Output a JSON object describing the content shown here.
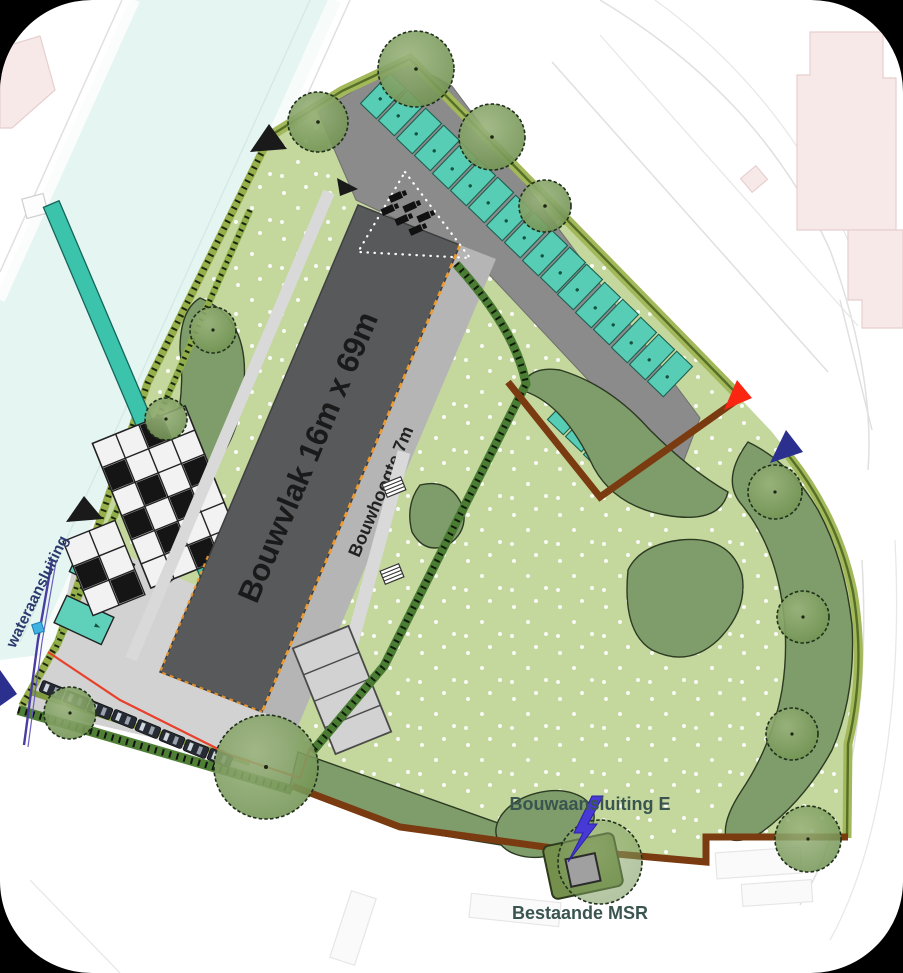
{
  "plan": {
    "title_labels": {
      "building_envelope": "Bouwvlak 16m x 69m",
      "building_height": "Bouwhoogte 7m",
      "water_connection": "wateraansluiting",
      "power_connection": "Bouwaansluiting E",
      "existing_msr": "Bestaande MSR"
    },
    "colors": {
      "lawn_green": "#c4d79d",
      "shrub_green": "#7e9d6a",
      "tree_green": "#78995c",
      "hedge_olive": "#a3b85a",
      "hedge_dark": "#4a7c33",
      "parking_teal": "#57cdb6",
      "strip_teal": "#3cc3ab",
      "road_gray": "#8b8b8b",
      "building_gray": "#58595b",
      "paving_gray": "#d2d2d2",
      "path_gray": "#d9d9d9",
      "boundary_brown": "#7a3b11",
      "accent_orange": "#ef9a2e",
      "utility_red_line": "#e8402a",
      "utility_purple_line": "#4a3da0",
      "water_square_blue": "#41b1e3",
      "marker_black": "#1a1a1a",
      "marker_red": "#fb2612",
      "marker_navy": "#2b2f8d",
      "lightning_blue": "#4739d6",
      "canal_cyan": "#e4f5f2",
      "pink_building": "#f8e9e9",
      "label_dark_green": "#3a5550",
      "label_navy": "#2c3a6e",
      "text_dark": "#1a1a1a"
    }
  }
}
